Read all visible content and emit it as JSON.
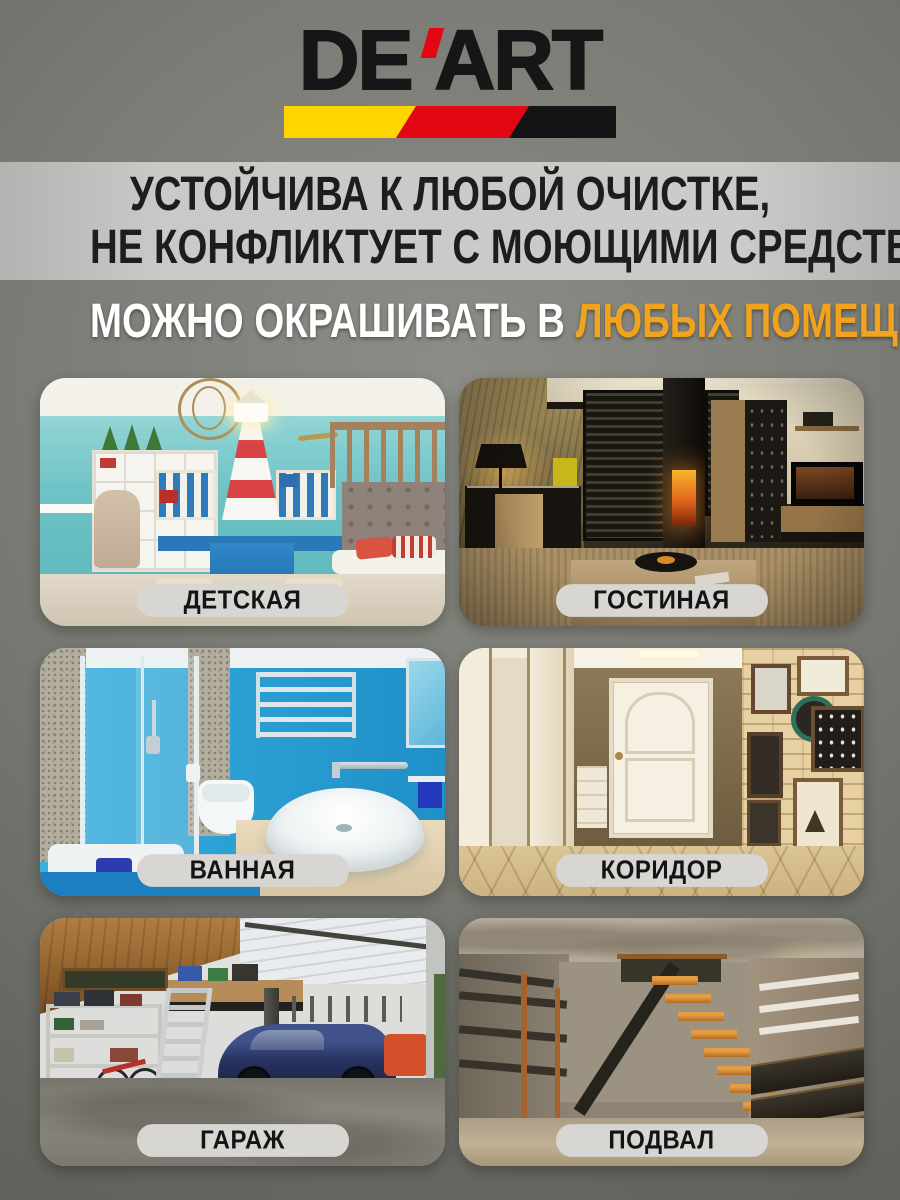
{
  "brand": {
    "prefix": "DE",
    "suffix": "ART",
    "text_color": "#161616",
    "apostrophe_color": "#e30613",
    "stripe_colors": [
      "#ffd500",
      "#e30613",
      "#141414"
    ]
  },
  "claims_banner": {
    "line1": "УСТОЙЧИВА К ЛЮБОЙ ОЧИСТКЕ,",
    "line2": "НЕ КОНФЛИКТУЕТ С МОЮЩИМИ СРЕДСТВАМИ",
    "band_color": "#c6c6c4",
    "text_color": "#1d1d1b"
  },
  "heading": {
    "white_part": "МОЖНО ОКРАШИВАТЬ В",
    "orange_part": "ЛЮБЫХ ПОМЕЩЕНИЯХ",
    "orange_color": "#f2a31e"
  },
  "label_pill_color": "#d7d6d3",
  "rooms": [
    {
      "label": "ДЕТСКАЯ",
      "photo": "kids-room"
    },
    {
      "label": "ГОСТИНАЯ",
      "photo": "living-room"
    },
    {
      "label": "ВАННАЯ",
      "photo": "bathroom"
    },
    {
      "label": "КОРИДОР",
      "photo": "hallway"
    },
    {
      "label": "ГАРАЖ",
      "photo": "garage"
    },
    {
      "label": "ПОДВАЛ",
      "photo": "basement"
    }
  ]
}
